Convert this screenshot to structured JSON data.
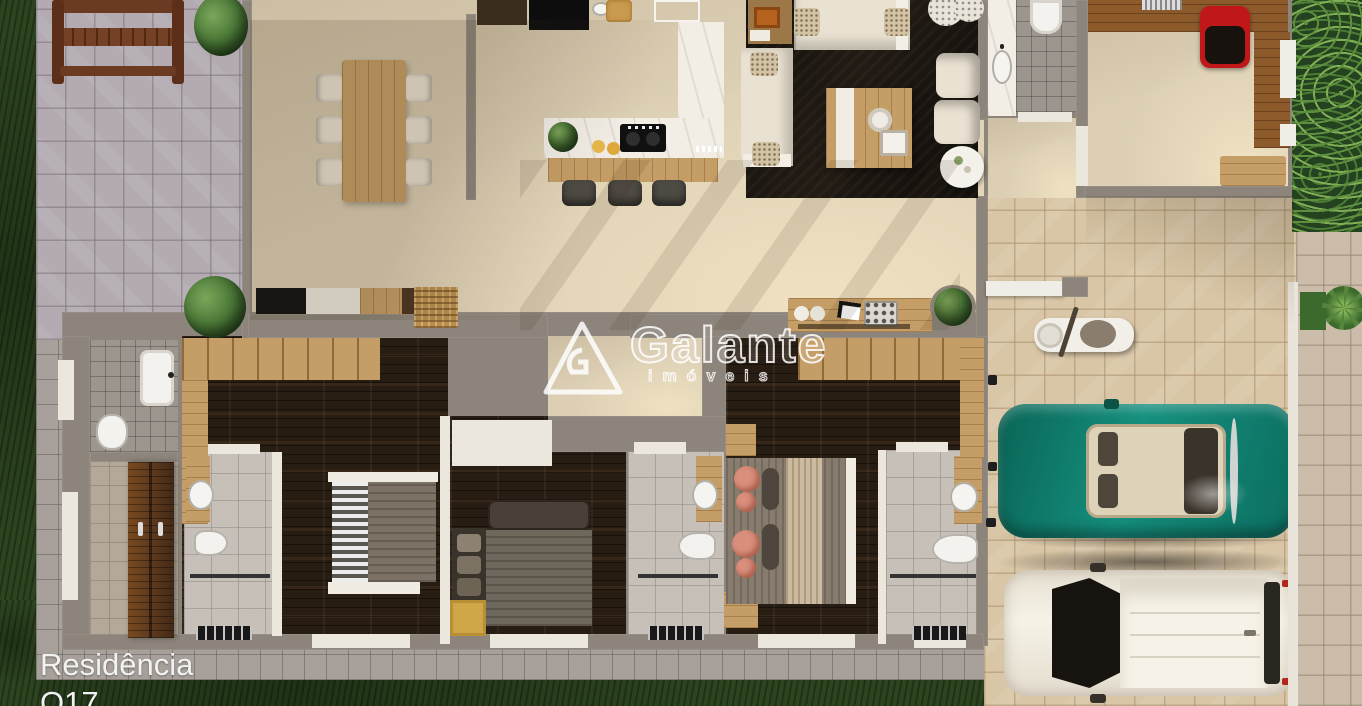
{
  "watermark": {
    "brand": "Galante",
    "subtitle": "imóveis",
    "logo": "outlined-triangle-logo"
  },
  "caption": {
    "line1": "Residência",
    "line2": "Q17"
  },
  "palette": {
    "grass": "#2c441f",
    "patio_paver": "#b3abb1",
    "driveway_paver": "#d9c6a6",
    "interior_floor": "#dccfb4",
    "wall": "#8d857b",
    "dark_wood_floor": "#281d13",
    "light_wood": "#c59d66",
    "kitchen_marble": "#f2eee6",
    "living_rug": "#221b14",
    "sofa_cream": "#e9e1d1",
    "teal_car": "#0e7a6b",
    "white_car": "#efe9dc",
    "bathroom_tile": "#c6c0b8",
    "office_chair_red": "#c01818",
    "bedroom_rug_yellow": "#cfa648",
    "salmon_pillow": "#d98f7c",
    "watermark_white": "#ffffff",
    "caption_white": "#f2f2f2"
  }
}
